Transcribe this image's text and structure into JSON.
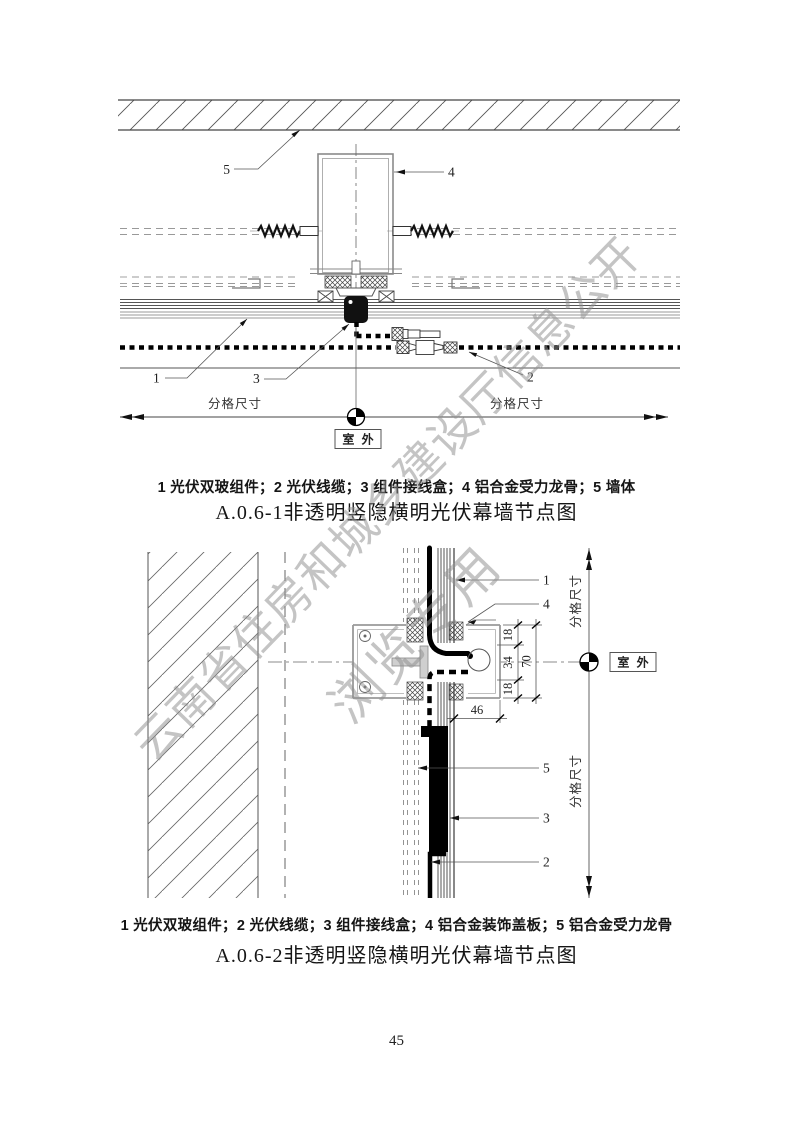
{
  "page_number": "45",
  "watermark": {
    "line1": "云南省住房和城乡建设厅信息公开",
    "line2": "浏览专用",
    "color": "#909090"
  },
  "d1": {
    "legend": "1 光伏双玻组件；2 光伏线缆；3 组件接线盒；4 铝合金受力龙骨；5 墙体",
    "title": "A.0.6-1非透明竖隐横明光伏幕墙节点图",
    "l1": "1",
    "l2": "2",
    "l3": "3",
    "l4": "4",
    "l5": "5",
    "dim_left": "分格尺寸",
    "dim_right": "分格尺寸",
    "outdoor": "室 外"
  },
  "d2": {
    "legend": "1 光伏双玻组件；2 光伏线缆；3 组件接线盒；4 铝合金装饰盖板；5 铝合金受力龙骨",
    "title": "A.0.6-2非透明竖隐横明光伏幕墙节点图",
    "l1": "1",
    "l2": "2",
    "l3": "3",
    "l4": "4",
    "l5": "5",
    "dim_18a": "18",
    "dim_34": "34",
    "dim_18b": "18",
    "dim_70": "70",
    "dim_46": "46",
    "dim_top": "分格尺寸",
    "dim_bottom": "分格尺寸",
    "outdoor": "室 外"
  }
}
